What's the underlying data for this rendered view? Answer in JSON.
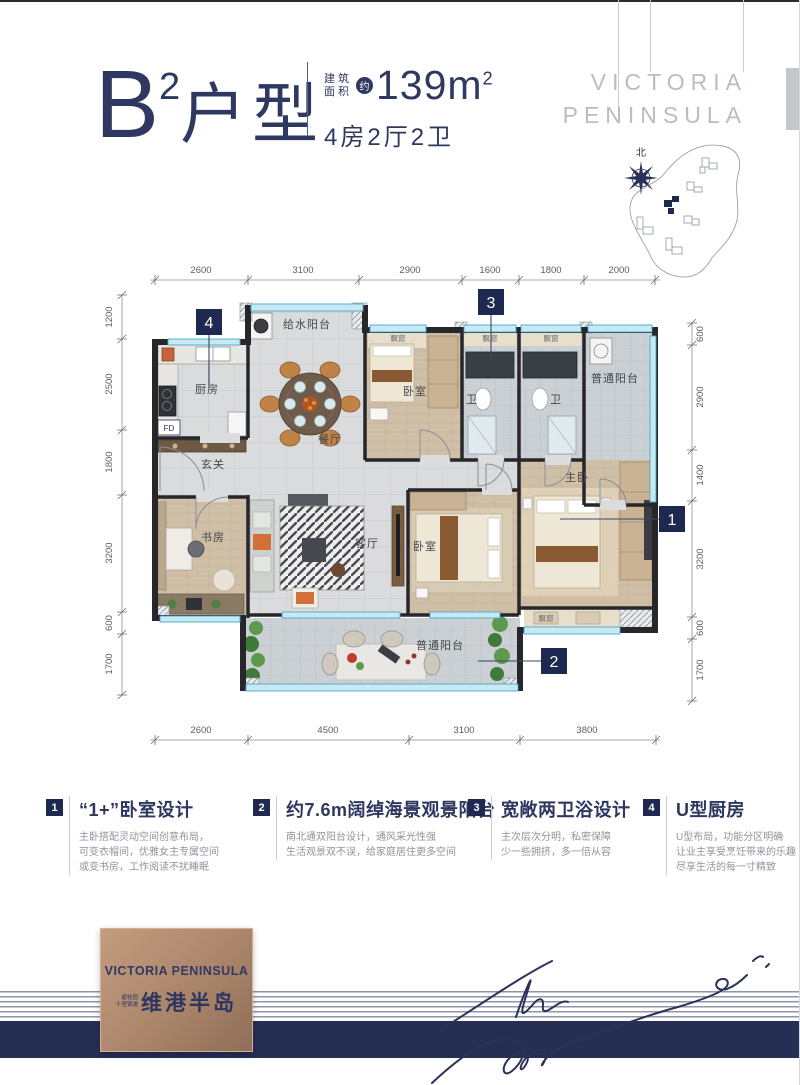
{
  "header": {
    "unit_letter": "B",
    "unit_sup": "2",
    "unit_type": "户型",
    "area_label_line1": "建筑",
    "area_label_line2": "面积",
    "area_circle": "约",
    "area_value": "139m",
    "area_value_sup": "2",
    "rooms_summary": "4房2厅2卫"
  },
  "brand": {
    "top_line1": "VICTORIA",
    "top_line2": "PENINSULA"
  },
  "compass": {
    "north": "北"
  },
  "floorplan": {
    "dims_top": [
      "2600",
      "3100",
      "2900",
      "1600",
      "1800",
      "2000"
    ],
    "dims_bottom": [
      "2600",
      "4500",
      "3100",
      "3800"
    ],
    "dims_left": [
      "1200",
      "2500",
      "1800",
      "3200",
      "600",
      "1700"
    ],
    "dims_right": [
      "600",
      "2900",
      "1400",
      "3200",
      "600",
      "1700"
    ],
    "rooms": {
      "kitchen": "厨房",
      "supply_balcony": "给水阳台",
      "dining": "餐厅",
      "foyer": "玄关",
      "bedroom_top": "卧室",
      "bath": "卫",
      "balcony_top": "普通阳台",
      "study": "书房",
      "living": "客厅",
      "bedroom_bottom": "卧室",
      "master": "主卧",
      "balcony_bottom": "普通阳台",
      "bay_window": "飘窗",
      "fd": "FD"
    },
    "markers": [
      "1",
      "2",
      "3",
      "4"
    ]
  },
  "features": [
    {
      "num": "1",
      "title": "“1+”卧室设计",
      "lines": [
        "主卧搭配灵动空间创意布局，",
        "可变衣帽间，优雅女主专属空间",
        "或变书房，工作阅读不扰睡眠"
      ]
    },
    {
      "num": "2",
      "title": "约7.6m阔绰海景观景阳台",
      "lines": [
        "南北通双阳台设计，通风采光性强",
        "生活观景双不误，给家庭居住更多空间"
      ]
    },
    {
      "num": "3",
      "title": "宽敞两卫浴设计",
      "lines": [
        "主次层次分明，私密保障",
        "少一些拥挤，多一倍从容"
      ]
    },
    {
      "num": "4",
      "title": "U型厨房",
      "lines": [
        "U型布局，功能分区明确",
        "让业主享受烹饪带来的乐趣",
        "尽享生活的每一寸精致"
      ]
    }
  ],
  "footer": {
    "logo_en": "VICTORIA PENINSULA",
    "logo_sub1": "碧桂园",
    "logo_sub2": "十里银滩",
    "logo_cn": "维港半岛"
  },
  "colors": {
    "navy": "#2e3860",
    "marker": "#1d2951",
    "bronze": "#b08a6e"
  }
}
